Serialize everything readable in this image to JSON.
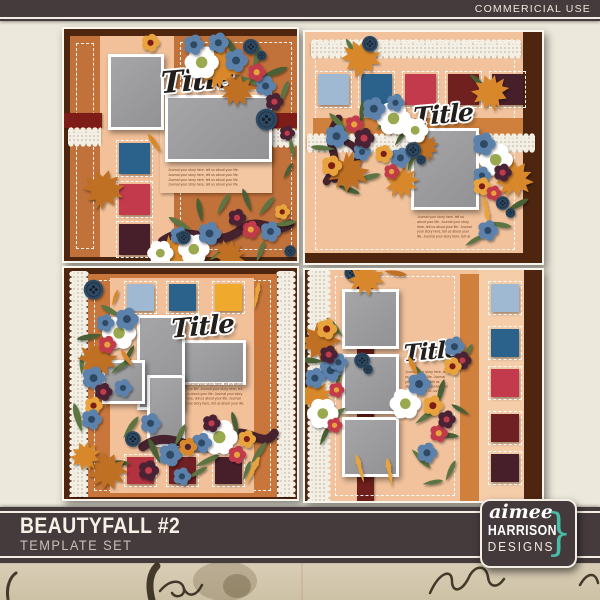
{
  "header": {
    "commercial_use_label": "COMMERICIAL USE"
  },
  "product": {
    "title": "BEAUTYFALL #2",
    "subtitle": "TEMPLATE SET"
  },
  "brand": {
    "name_script": "aimee",
    "name_caps": "HARRISON",
    "name_sub": "DESIGNS",
    "brace": "}"
  },
  "template_common": {
    "title_text": "Title",
    "journaling_text": "Journal your story here, tell us about your life. Journal your story here, tell us about your life. Journal your story here, tell us about your life. Journal your story here, tell us about your life."
  },
  "templates": [
    {
      "id": "top-left",
      "squares": [
        "#2A628B",
        "#C23A4C",
        "#471F2B"
      ]
    },
    {
      "id": "top-right",
      "squares": [
        "#9FB9D3",
        "#2A628B",
        "#C23A4C",
        "#70211F",
        "#471F2B"
      ]
    },
    {
      "id": "bottom-left",
      "squares_top": [
        "#9FB9D3",
        "#2A628B",
        "#EFA92C"
      ],
      "squares_bottom": [
        "#B23240",
        "#6E2023",
        "#471F2B"
      ]
    },
    {
      "id": "bottom-right",
      "squares": [
        "#9FB9D3",
        "#2A628B",
        "#C23A4C",
        "#6E2023",
        "#471F2B"
      ]
    }
  ],
  "decor_elements": [
    "flower",
    "maple-leaf",
    "leaf",
    "oak-leaf",
    "button",
    "ribbon",
    "lace",
    "stitching"
  ],
  "colors": {
    "background": "#ECE8DB",
    "banner": "#453A3C",
    "banner_line": "#F2EEE3",
    "paper": "#D6CBB2",
    "ink": "#2A2113",
    "accent_teal": "#48BCA7",
    "peach": "#F1C29C",
    "peach_light": "#F5CDA9",
    "orange": "#C8763B",
    "orange_band": "#CF803C",
    "brown": "#4E2610",
    "maroon": "#7E1D18",
    "maroon_strip": "#6E1F1C",
    "photo_gray": "#9B9B9D",
    "leaf_green": "#5C7442",
    "leaf_green_dark": "#495E35",
    "maple_orange": "#D8882B",
    "maple_rust": "#C06F22",
    "flower_blue": "#5B82AC",
    "flower_navy": "#2E4A63",
    "flower_red": "#C13A4B",
    "flower_yellow": "#E8A33D",
    "flower_plum": "#4A2334",
    "flower_white": "#FFFFFF",
    "flower_olive": "#9AA94F",
    "ribbon_plum": "#45222E",
    "lace": "#F3EFE4",
    "title_color": "#211E1C"
  }
}
